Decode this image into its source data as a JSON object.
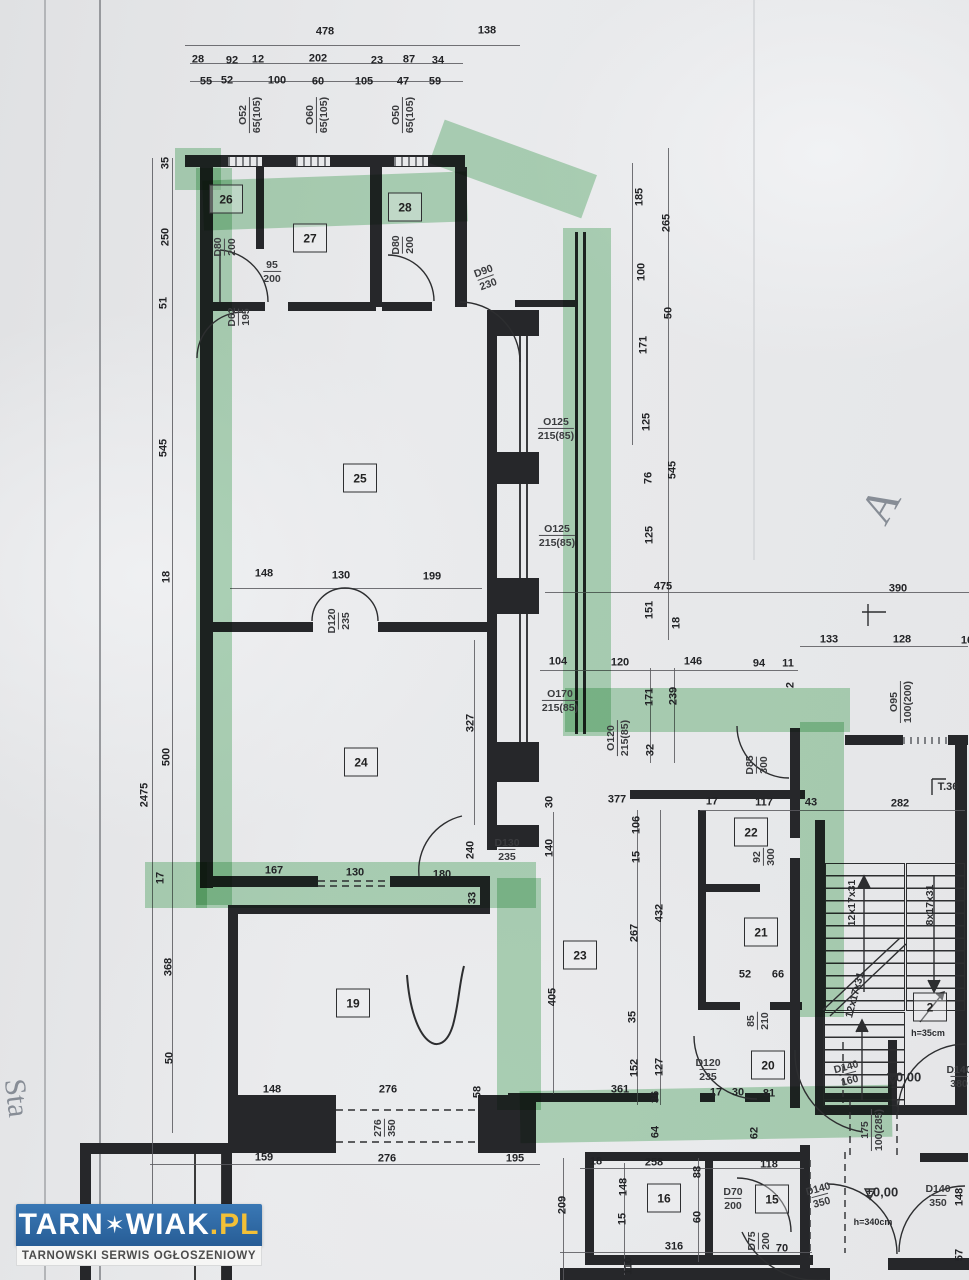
{
  "watermark": {
    "brand_prefix": "TARN",
    "brand_star": "✶",
    "brand_suffix": "WIAK",
    "brand_dot_pl": ".PL",
    "tagline": "TARNOWSKI SERWIS OGŁOSZENIOWY",
    "bar_color": "#2e6ba8",
    "pl_color": "#f2c037",
    "tagline_color": "#4c4c4c"
  },
  "plan": {
    "highlight_color": "#68ba7a",
    "ink_color": "#26272a",
    "rooms": [
      {
        "n": "26",
        "x": 226,
        "y": 199
      },
      {
        "n": "27",
        "x": 310,
        "y": 238
      },
      {
        "n": "28",
        "x": 405,
        "y": 207
      },
      {
        "n": "25",
        "x": 360,
        "y": 478
      },
      {
        "n": "24",
        "x": 361,
        "y": 762
      },
      {
        "n": "23",
        "x": 580,
        "y": 955
      },
      {
        "n": "22",
        "x": 751,
        "y": 832
      },
      {
        "n": "21",
        "x": 761,
        "y": 932
      },
      {
        "n": "19",
        "x": 353,
        "y": 1003
      },
      {
        "n": "20",
        "x": 768,
        "y": 1065
      },
      {
        "n": "16",
        "x": 664,
        "y": 1198
      },
      {
        "n": "15",
        "x": 772,
        "y": 1199
      },
      {
        "n": "2",
        "x": 930,
        "y": 1007
      }
    ],
    "dims": [
      {
        "t": "478",
        "x": 325,
        "y": 32
      },
      {
        "t": "138",
        "x": 487,
        "y": 31
      },
      {
        "t": "28",
        "x": 198,
        "y": 60
      },
      {
        "t": "92",
        "x": 232,
        "y": 61
      },
      {
        "t": "12",
        "x": 258,
        "y": 60
      },
      {
        "t": "202",
        "x": 318,
        "y": 59
      },
      {
        "t": "23",
        "x": 377,
        "y": 61
      },
      {
        "t": "87",
        "x": 409,
        "y": 60
      },
      {
        "t": "34",
        "x": 438,
        "y": 61
      },
      {
        "t": "55",
        "x": 206,
        "y": 82
      },
      {
        "t": "52",
        "x": 227,
        "y": 81
      },
      {
        "t": "100",
        "x": 277,
        "y": 81
      },
      {
        "t": "60",
        "x": 318,
        "y": 82
      },
      {
        "t": "105",
        "x": 364,
        "y": 82
      },
      {
        "t": "47",
        "x": 403,
        "y": 82
      },
      {
        "t": "59",
        "x": 435,
        "y": 82
      },
      {
        "t": "35",
        "x": 166,
        "y": 163,
        "r": -90
      },
      {
        "t": "250",
        "x": 166,
        "y": 237,
        "r": -90
      },
      {
        "t": "51",
        "x": 164,
        "y": 303,
        "r": -90
      },
      {
        "t": "545",
        "x": 164,
        "y": 448,
        "r": -90
      },
      {
        "t": "18",
        "x": 167,
        "y": 577,
        "r": -90
      },
      {
        "t": "500",
        "x": 167,
        "y": 757,
        "r": -90
      },
      {
        "t": "2475",
        "x": 145,
        "y": 795,
        "r": -90
      },
      {
        "t": "17",
        "x": 161,
        "y": 878,
        "r": -90
      },
      {
        "t": "368",
        "x": 169,
        "y": 967,
        "r": -90
      },
      {
        "t": "50",
        "x": 170,
        "y": 1058,
        "r": -90
      },
      {
        "t": "185",
        "x": 640,
        "y": 197,
        "r": -90
      },
      {
        "t": "265",
        "x": 667,
        "y": 223,
        "r": -90
      },
      {
        "t": "100",
        "x": 642,
        "y": 272,
        "r": -90
      },
      {
        "t": "50",
        "x": 669,
        "y": 313,
        "r": -90
      },
      {
        "t": "171",
        "x": 644,
        "y": 345,
        "r": -90
      },
      {
        "t": "125",
        "x": 647,
        "y": 422,
        "r": -90
      },
      {
        "t": "545",
        "x": 673,
        "y": 470,
        "r": -90
      },
      {
        "t": "76",
        "x": 649,
        "y": 478,
        "r": -90
      },
      {
        "t": "125",
        "x": 650,
        "y": 535,
        "r": -90
      },
      {
        "t": "475",
        "x": 663,
        "y": 587
      },
      {
        "t": "151",
        "x": 650,
        "y": 610,
        "r": -90
      },
      {
        "t": "18",
        "x": 677,
        "y": 623,
        "r": -90
      },
      {
        "t": "390",
        "x": 898,
        "y": 589
      },
      {
        "t": "133",
        "x": 829,
        "y": 640
      },
      {
        "t": "128",
        "x": 902,
        "y": 640
      },
      {
        "t": "16",
        "x": 967,
        "y": 641
      },
      {
        "t": "104",
        "x": 558,
        "y": 662
      },
      {
        "t": "120",
        "x": 620,
        "y": 663
      },
      {
        "t": "146",
        "x": 693,
        "y": 662
      },
      {
        "t": "94",
        "x": 759,
        "y": 664
      },
      {
        "t": "11",
        "x": 788,
        "y": 664
      },
      {
        "t": "2",
        "x": 791,
        "y": 685,
        "r": -90
      },
      {
        "t": "171",
        "x": 650,
        "y": 697,
        "r": -90
      },
      {
        "t": "239",
        "x": 674,
        "y": 696,
        "r": -90
      },
      {
        "t": "32",
        "x": 651,
        "y": 750,
        "r": -90
      },
      {
        "t": "148",
        "x": 264,
        "y": 574
      },
      {
        "t": "130",
        "x": 341,
        "y": 576
      },
      {
        "t": "199",
        "x": 432,
        "y": 577
      },
      {
        "t": "327",
        "x": 471,
        "y": 723,
        "r": -90
      },
      {
        "t": "377",
        "x": 617,
        "y": 800
      },
      {
        "t": "30",
        "x": 550,
        "y": 802,
        "r": -90
      },
      {
        "t": "17",
        "x": 712,
        "y": 802
      },
      {
        "t": "117",
        "x": 764,
        "y": 803
      },
      {
        "t": "43",
        "x": 811,
        "y": 803
      },
      {
        "t": "282",
        "x": 900,
        "y": 804
      },
      {
        "t": "140",
        "x": 550,
        "y": 848,
        "r": -90
      },
      {
        "t": "106",
        "x": 637,
        "y": 825,
        "r": -90
      },
      {
        "t": "15",
        "x": 637,
        "y": 857,
        "r": -90
      },
      {
        "t": "240",
        "x": 471,
        "y": 850,
        "r": -90
      },
      {
        "t": "33",
        "x": 473,
        "y": 898,
        "r": -90
      },
      {
        "t": "167",
        "x": 274,
        "y": 871
      },
      {
        "t": "130",
        "x": 355,
        "y": 873
      },
      {
        "t": "180",
        "x": 442,
        "y": 875
      },
      {
        "t": "432",
        "x": 660,
        "y": 913,
        "r": -90
      },
      {
        "t": "267",
        "x": 635,
        "y": 933,
        "r": -90
      },
      {
        "t": "52",
        "x": 745,
        "y": 975
      },
      {
        "t": "66",
        "x": 778,
        "y": 975
      },
      {
        "t": "405",
        "x": 553,
        "y": 997,
        "r": -90
      },
      {
        "t": "35",
        "x": 633,
        "y": 1017,
        "r": -90
      },
      {
        "t": "152",
        "x": 635,
        "y": 1068,
        "r": -90
      },
      {
        "t": "127",
        "x": 660,
        "y": 1067,
        "r": -90
      },
      {
        "t": "148",
        "x": 272,
        "y": 1090
      },
      {
        "t": "276",
        "x": 388,
        "y": 1090
      },
      {
        "t": "58",
        "x": 478,
        "y": 1092,
        "r": -90
      },
      {
        "t": "361",
        "x": 620,
        "y": 1090
      },
      {
        "t": "36",
        "x": 656,
        "y": 1097,
        "r": -90
      },
      {
        "t": "17",
        "x": 716,
        "y": 1093
      },
      {
        "t": "30",
        "x": 738,
        "y": 1093
      },
      {
        "t": "81",
        "x": 769,
        "y": 1094
      },
      {
        "t": "64",
        "x": 656,
        "y": 1132,
        "r": -90
      },
      {
        "t": "62",
        "x": 755,
        "y": 1133,
        "r": -90
      },
      {
        "t": "159",
        "x": 264,
        "y": 1158
      },
      {
        "t": "276",
        "x": 387,
        "y": 1159
      },
      {
        "t": "195",
        "x": 515,
        "y": 1159
      },
      {
        "t": "18",
        "x": 596,
        "y": 1162
      },
      {
        "t": "258",
        "x": 654,
        "y": 1163
      },
      {
        "t": "118",
        "x": 769,
        "y": 1165
      },
      {
        "t": "88",
        "x": 698,
        "y": 1172,
        "r": -90
      },
      {
        "t": "60",
        "x": 698,
        "y": 1217,
        "r": -90
      },
      {
        "t": "148",
        "x": 624,
        "y": 1187,
        "r": -90
      },
      {
        "t": "15",
        "x": 623,
        "y": 1219,
        "r": -90
      },
      {
        "t": "209",
        "x": 563,
        "y": 1205,
        "r": -90
      },
      {
        "t": "110",
        "x": 629,
        "y": 1266,
        "r": -90
      },
      {
        "t": "316",
        "x": 674,
        "y": 1247
      },
      {
        "t": "70",
        "x": 782,
        "y": 1249
      },
      {
        "t": "148",
        "x": 960,
        "y": 1197,
        "r": -90
      },
      {
        "t": "57",
        "x": 960,
        "y": 1255,
        "r": -90
      }
    ],
    "fracs": [
      {
        "a": "O52",
        "b": "65(105)",
        "x": 250,
        "y": 115,
        "r": -90
      },
      {
        "a": "O60",
        "b": "65(105)",
        "x": 317,
        "y": 115,
        "r": -90
      },
      {
        "a": "O50",
        "b": "65(105)",
        "x": 403,
        "y": 115,
        "r": -90
      },
      {
        "a": "D80",
        "b": "200",
        "x": 225,
        "y": 247,
        "r": -90
      },
      {
        "a": "95",
        "b": "200",
        "x": 272,
        "y": 272
      },
      {
        "a": "D62",
        "b": "195",
        "x": 239,
        "y": 317,
        "r": -90
      },
      {
        "a": "D80",
        "b": "200",
        "x": 403,
        "y": 245,
        "r": -90
      },
      {
        "a": "D90",
        "b": "230",
        "x": 486,
        "y": 278,
        "r": -20
      },
      {
        "a": "O125",
        "b": "215(85)",
        "x": 556,
        "y": 429
      },
      {
        "a": "O125",
        "b": "215(85)",
        "x": 557,
        "y": 536
      },
      {
        "a": "D120",
        "b": "235",
        "x": 339,
        "y": 621,
        "r": -90
      },
      {
        "a": "O170",
        "b": "215(85)",
        "x": 560,
        "y": 701
      },
      {
        "a": "O120",
        "b": "215(85)",
        "x": 618,
        "y": 738,
        "r": -90
      },
      {
        "a": "D85",
        "b": "300",
        "x": 757,
        "y": 765,
        "r": -90
      },
      {
        "a": "O95",
        "b": "100(200)",
        "x": 901,
        "y": 702,
        "r": -90
      },
      {
        "a": "92",
        "b": "300",
        "x": 764,
        "y": 857,
        "r": -90
      },
      {
        "a": "D130",
        "b": "235",
        "x": 507,
        "y": 850
      },
      {
        "a": "85",
        "b": "210",
        "x": 758,
        "y": 1021,
        "r": -90
      },
      {
        "a": "D120",
        "b": "235",
        "x": 708,
        "y": 1070
      },
      {
        "a": "D140",
        "b": "160",
        "x": 848,
        "y": 1074,
        "r": -15
      },
      {
        "a": "D140",
        "b": "380",
        "x": 959,
        "y": 1077
      },
      {
        "a": "175",
        "b": "100(285)",
        "x": 872,
        "y": 1130,
        "r": -90
      },
      {
        "a": "D70",
        "b": "200",
        "x": 733,
        "y": 1199
      },
      {
        "a": "D75",
        "b": "200",
        "x": 759,
        "y": 1241,
        "r": -90
      },
      {
        "a": "D140",
        "b": "350",
        "x": 820,
        "y": 1196,
        "r": -15
      },
      {
        "a": "D140",
        "b": "350",
        "x": 938,
        "y": 1196
      },
      {
        "a": "276",
        "b": "350",
        "x": 385,
        "y": 1128,
        "r": -90
      }
    ],
    "texts": [
      {
        "t": "±0,00",
        "x": 905,
        "y": 1077,
        "s": 13
      },
      {
        "t": "±0,00",
        "x": 882,
        "y": 1192,
        "s": 13
      },
      {
        "t": "h=35cm",
        "x": 928,
        "y": 1033,
        "s": 9
      },
      {
        "t": "h=340cm",
        "x": 873,
        "y": 1222,
        "s": 9
      },
      {
        "t": "T.36",
        "x": 948,
        "y": 787,
        "s": 11
      },
      {
        "t": "12x17x31",
        "x": 852,
        "y": 903,
        "s": 10.5,
        "r": -90
      },
      {
        "t": "8x17x31",
        "x": 930,
        "y": 905,
        "s": 10.5,
        "r": -90
      },
      {
        "t": "12x17x31",
        "x": 855,
        "y": 995,
        "s": 10.5,
        "r": -75
      },
      {
        "t": "A",
        "x": 880,
        "y": 505,
        "s": 46,
        "r": -60,
        "g": 1
      },
      {
        "t": "Sta",
        "x": 16,
        "y": 1098,
        "s": 30,
        "r": 83,
        "g": 1
      }
    ]
  }
}
